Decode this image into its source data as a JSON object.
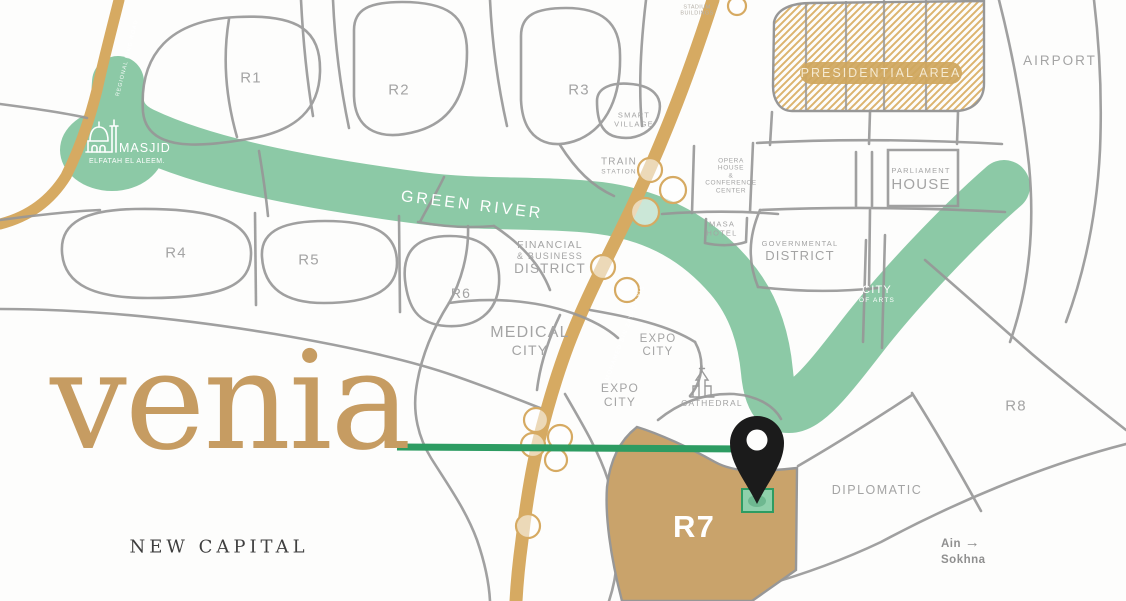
{
  "brand": {
    "logo": "venia",
    "tagline": "NEW CAPITAL"
  },
  "theme": {
    "green": "#8CC9A6",
    "green-dark": "#2D9C62",
    "plot": "#8FD0AB",
    "gold-road": "#D6AA62",
    "tan": "#C9A36B",
    "hatch": "#DCB46F",
    "pill": "#D0A75E",
    "gray-road": "#979797",
    "label": "#a4a4a4",
    "white-label": "#ffffff",
    "logo-gold": "#C69C62",
    "ink": "#3F3F3F",
    "pin": "#1b1b1b",
    "bg": "#fdfdfc"
  },
  "map": {
    "labels": {
      "green_river": "GREEN RIVER",
      "masjid_title": "MASJID",
      "masjid_subtitle": "ELFATAH EL ALEEM.",
      "r1": "R1",
      "r2": "R2",
      "r3": "R3",
      "r4": "R4",
      "r5": "R5",
      "r6": "R6",
      "r7": "R7",
      "r8": "R8",
      "smart_village_l1": "SMART",
      "smart_village_l2": "VILLAGE",
      "train_l1": "TRAIN",
      "train_l2": "STATION",
      "opera_l1": "OPERA",
      "opera_l2": "HOUSE",
      "opera_l3": "&",
      "opera_l4": "CONFERENCE",
      "opera_l5": "CENTER",
      "masa_l1": "MASA",
      "masa_l2": "HOTEL",
      "financial_l1": "FINANCIAL",
      "financial_l2": "& BUSINESS",
      "financial_l3": "DISTRICT",
      "medical_l1": "MEDICAL",
      "medical_l2": "CITY",
      "expo1_l1": "EXPO",
      "expo1_l2": "CITY",
      "expo2_l1": "EXPO",
      "expo2_l2": "CITY",
      "cathedral": "CATHEDRAL",
      "governmental_l1": "GOVERNMENTAL",
      "governmental_l2": "DISTRICT",
      "parliament_l1": "PARLIAMENT",
      "parliament_l2": "HOUSE",
      "city_of_arts_l1": "CITY",
      "city_of_arts_l2": "OF ARTS",
      "presidential": "PRESIDENTIAL AREA",
      "airport": "AIRPORT",
      "diplomatic": "DIPLOMATIC",
      "stadium_l1": "STADIUM",
      "stadium_l2": "BUILDINGS",
      "road_central": "MOHAMED BIN ZAYED AXIS",
      "road_left": "REGIONAL RING ROAD",
      "ain_l1": "Ain",
      "ain_arrow": "→",
      "ain_l2": "Sokhna"
    }
  }
}
